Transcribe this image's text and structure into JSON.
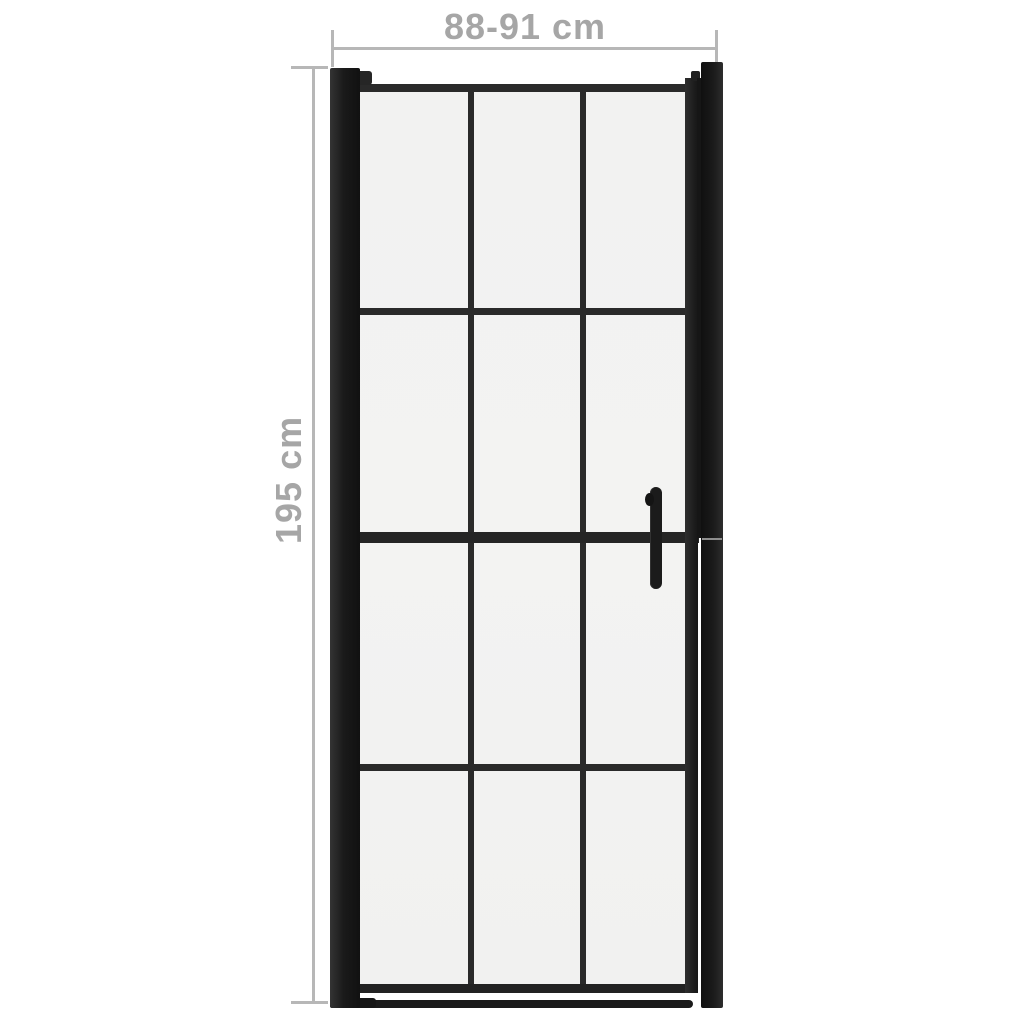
{
  "figure": {
    "width_dimension": "88-91 cm",
    "height_dimension": "195 cm"
  },
  "colors": {
    "background": "#ffffff",
    "dimension_line": "#b7b7b7",
    "dimension_text": "#a6a6a6",
    "frame_dark": "#1a1a1a",
    "frame_mid": "#2a2a2a",
    "glass": "#f3f3f2",
    "seam": "#8e8e8e",
    "handle": "#1b1b1b"
  }
}
